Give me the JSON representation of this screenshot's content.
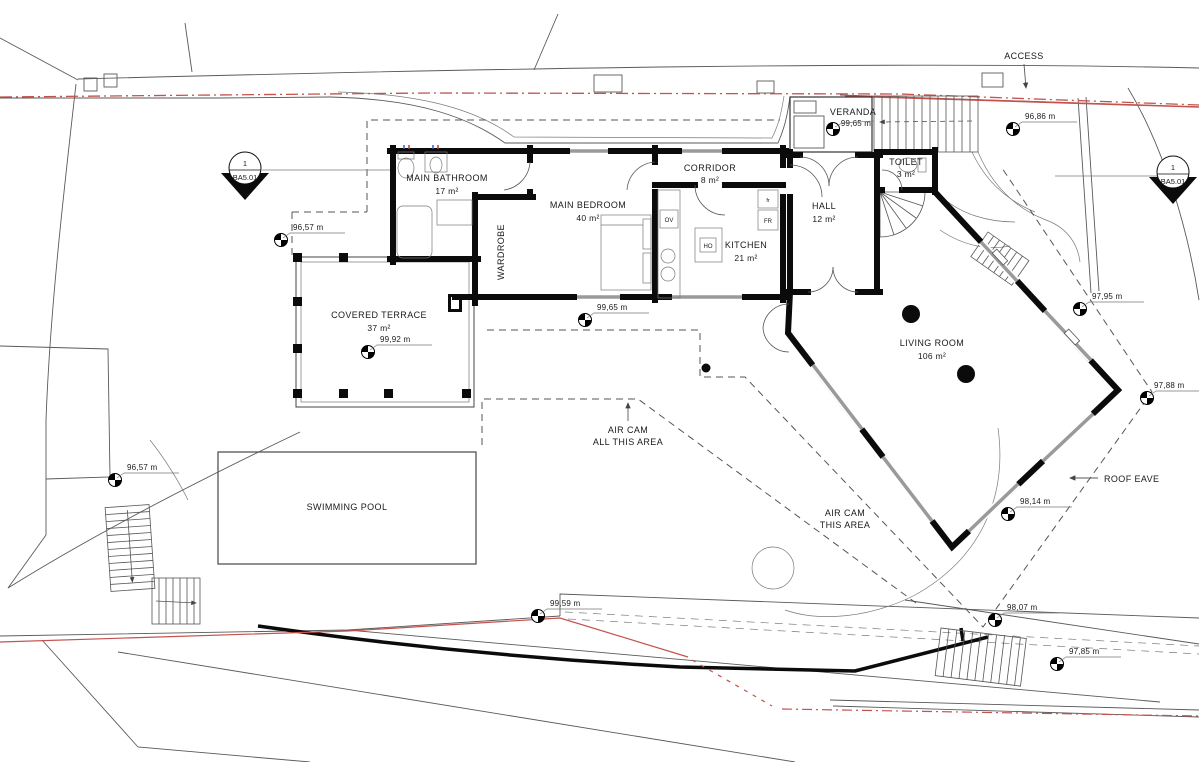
{
  "plan": {
    "rooms": {
      "main_bathroom": {
        "name": "MAIN BATHROOM",
        "area": "17 m²"
      },
      "wardrobe": {
        "name": "WARDROBE"
      },
      "main_bedroom": {
        "name": "MAIN BEDROOM",
        "area": "40 m²"
      },
      "corridor": {
        "name": "CORRIDOR",
        "area": "8 m²"
      },
      "kitchen": {
        "name": "KITCHEN",
        "area": "21 m²"
      },
      "hall": {
        "name": "HALL",
        "area": "12 m²"
      },
      "toilet": {
        "name": "TOILET",
        "area": "3 m²"
      },
      "veranda": {
        "name": "VERANDA",
        "level": "99,65 m"
      },
      "living_room": {
        "name": "LIVING ROOM",
        "area": "106 m²"
      },
      "covered_terrace": {
        "name": "COVERED TERRACE",
        "area": "37 m²"
      },
      "swimming_pool": {
        "name": "SWIMMING POOL"
      }
    },
    "appliances": {
      "oven": "OV",
      "hob": "HO",
      "fridge_small": "fr",
      "fridge": "FR"
    },
    "annotations": {
      "access": "ACCESS",
      "roof_eave": "ROOF EAVE",
      "air_cam_all_line1": "AIR CAM",
      "air_cam_all_line2": "ALL THIS AREA",
      "air_cam_this_line1": "AIR CAM",
      "air_cam_this_line2": "THIS AREA"
    },
    "section_marker": {
      "number": "1",
      "sheet": "BA5.01"
    },
    "elevations": {
      "terrace_nw": "96,57 m",
      "stairs_w": "96,57 m",
      "bedroom_s": "99,65 m",
      "terrace": "99,92 m",
      "access_e": "96,86 m",
      "living_ne": "97,95 m",
      "eave_e": "97,88 m",
      "living_se": "98,14 m",
      "path_s": "98,07 m",
      "stairs_se": "97,85 m",
      "wall_s": "99,59 m"
    },
    "colors": {
      "boundary_red": "#c4524d",
      "wall_black": "#0b0b0b",
      "line_gray": "#5a5a5a"
    }
  }
}
